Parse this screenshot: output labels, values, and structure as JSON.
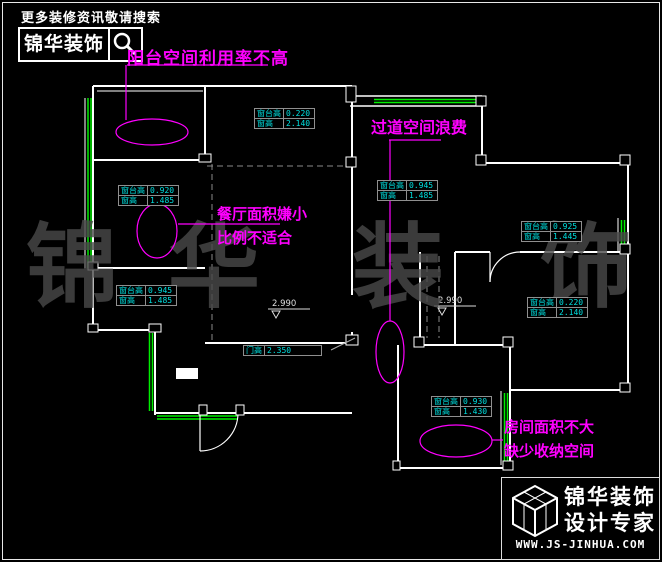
{
  "header": {
    "tagline": "更多装修资讯敬请搜索",
    "brand": "锦华装饰"
  },
  "annotations": {
    "balcony": {
      "text": "阳台空间利用率不高"
    },
    "dining": {
      "line1": "餐厅面积嫌小",
      "line2": "比例不适合"
    },
    "corridor": {
      "text": "过道空间浪费"
    },
    "bedroom": {
      "line1": "房间面积不大",
      "line2": "缺少收纳空间"
    }
  },
  "window_tables": [
    {
      "id": "living-top",
      "rows": [
        {
          "label": "窗台高",
          "value": "0.220"
        },
        {
          "label": "窗高",
          "value": "2.140"
        }
      ]
    },
    {
      "id": "dining-left",
      "rows": [
        {
          "label": "窗台高",
          "value": "0.920"
        },
        {
          "label": "窗高",
          "value": "1.485"
        }
      ]
    },
    {
      "id": "corridor",
      "rows": [
        {
          "label": "窗台高",
          "value": "0.945"
        },
        {
          "label": "窗高",
          "value": "1.485"
        }
      ]
    },
    {
      "id": "left-lower",
      "rows": [
        {
          "label": "窗台高",
          "value": "0.945"
        },
        {
          "label": "窗高",
          "value": "1.485"
        }
      ]
    },
    {
      "id": "right-upper",
      "rows": [
        {
          "label": "窗台高",
          "value": "0.925"
        },
        {
          "label": "窗高",
          "value": "1.445"
        }
      ]
    },
    {
      "id": "right-lower",
      "rows": [
        {
          "label": "窗台高",
          "value": "0.220"
        },
        {
          "label": "窗高",
          "value": "2.140"
        }
      ]
    },
    {
      "id": "bottom-right",
      "rows": [
        {
          "label": "窗台高",
          "value": "0.930"
        },
        {
          "label": "窗高",
          "value": "1.430"
        }
      ]
    }
  ],
  "door_table": {
    "label": "门高",
    "value": "2.350"
  },
  "elevation_markers": [
    {
      "value": "2.990"
    },
    {
      "value": "2.990"
    }
  ],
  "watermark": {
    "char1": "锦",
    "char2": "华",
    "char3": "装",
    "char4": "饰"
  },
  "footer": {
    "brand_line1": "锦华装饰",
    "brand_line2": "设计专家",
    "url": "WWW.JS-JINHUA.COM"
  },
  "colors": {
    "annotation": "#ff00ff",
    "dimension_text": "#00e0e0",
    "wall": "#ffffff",
    "window": "#00ee00",
    "background": "#000000"
  }
}
